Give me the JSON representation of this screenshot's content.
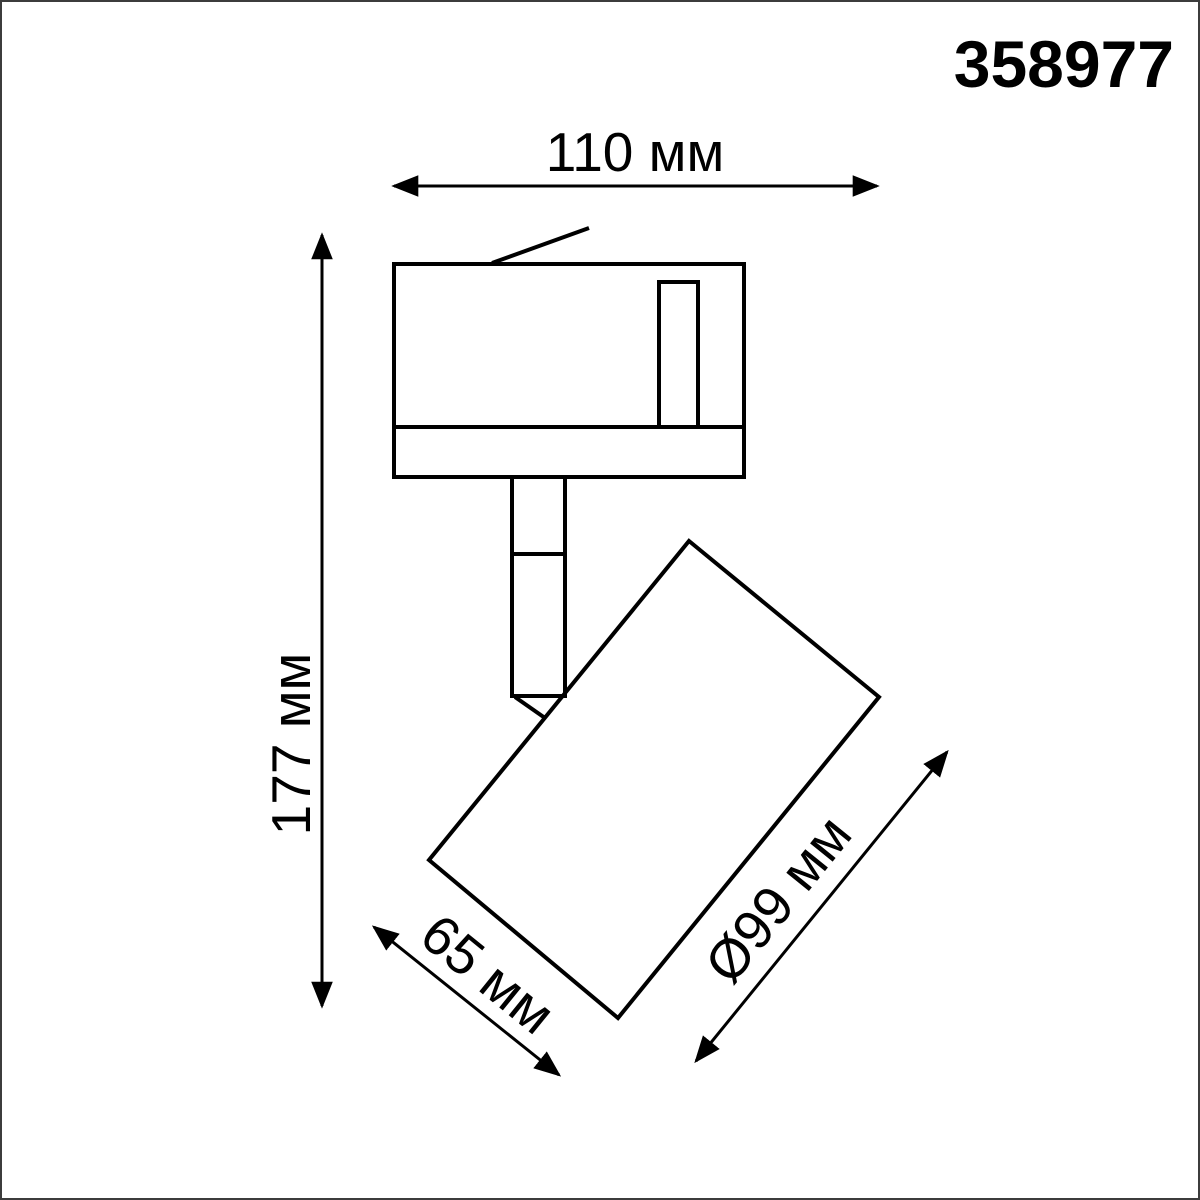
{
  "page": {
    "background_color": "#ffffff",
    "frame_color": "#3c3c3c",
    "line_color": "#000000"
  },
  "header": {
    "product_code": "358977"
  },
  "drawing": {
    "dimensions": {
      "overall_width": "110 мм",
      "overall_height": "177 мм",
      "head_length": "65 мм",
      "head_diameter": "Ø99 мм"
    }
  }
}
